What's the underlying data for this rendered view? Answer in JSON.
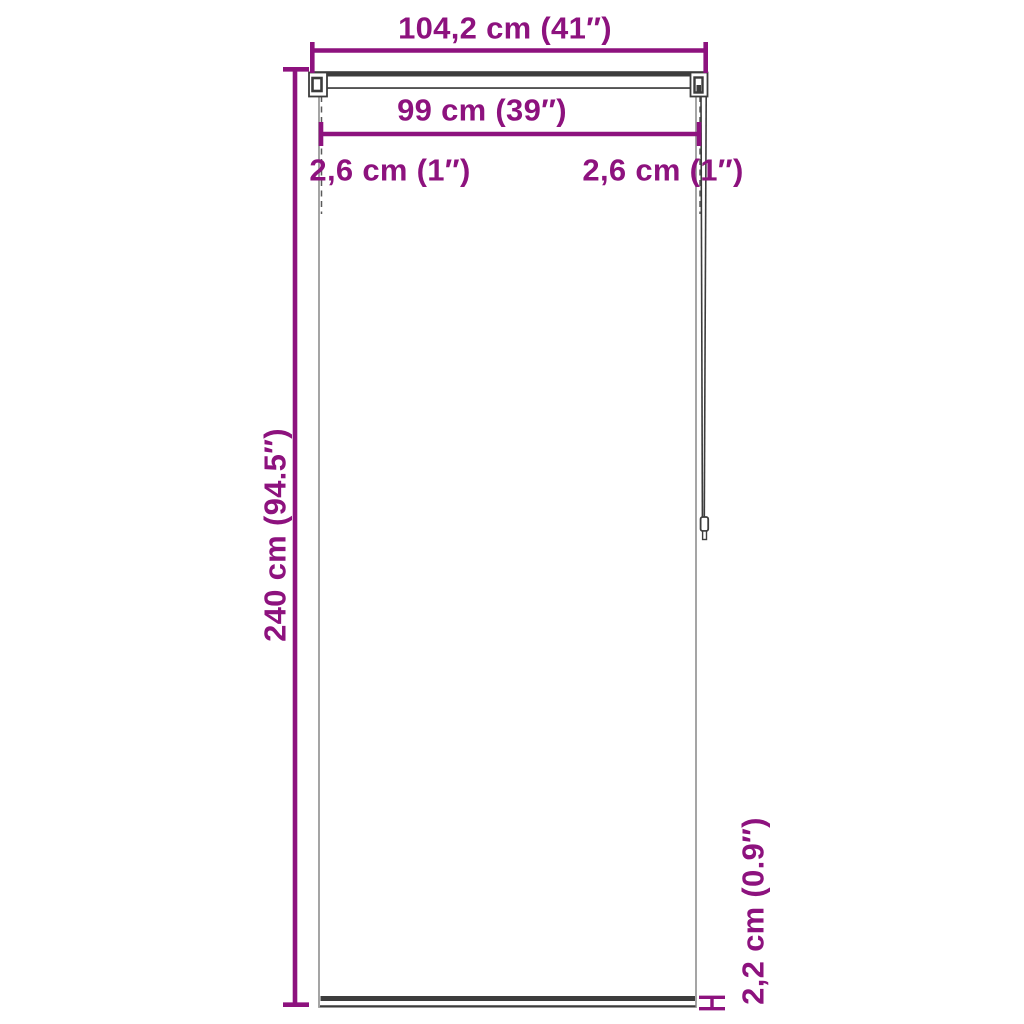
{
  "labels": {
    "total_width": "104,2 cm (41″)",
    "fabric_width": "99 cm (39″)",
    "left_margin": "2,6 cm (1″)",
    "right_margin": "2,6 cm (1″)",
    "height": "240 cm (94.5″)",
    "bottom_bar_height": "2,2 cm (0.9″)"
  },
  "colors": {
    "dimension_accent": "#8D127E",
    "outline_dark": "#3C3C3C",
    "fabric_edge": "#9B9B9B",
    "background": "#FFFFFF"
  }
}
